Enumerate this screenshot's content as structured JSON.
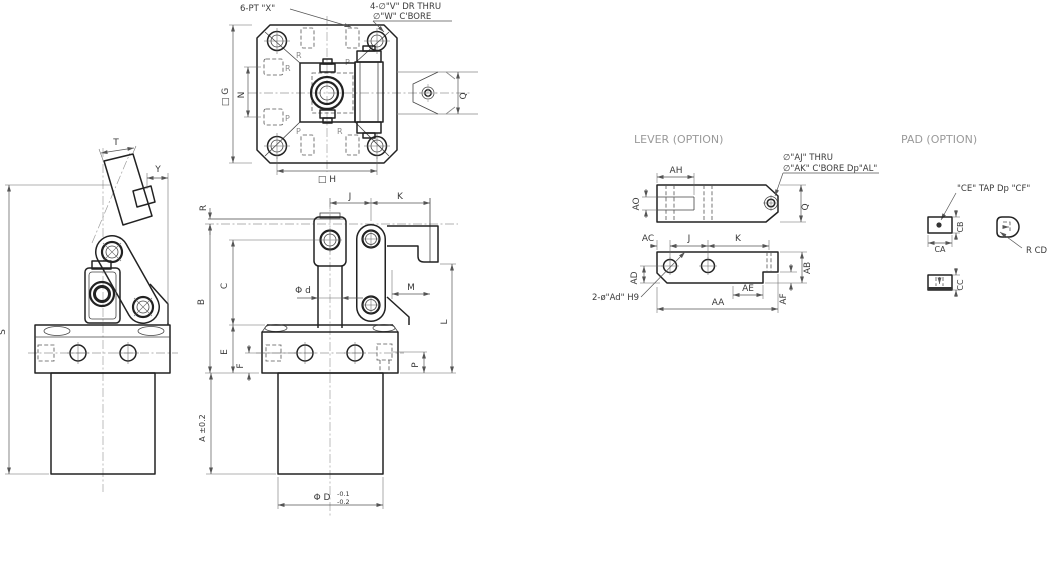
{
  "titles": {
    "lever": "LEVER (OPTION)",
    "pad": "PAD (OPTION)"
  },
  "top_view": {
    "callout_port": "6-PT \"X\"",
    "callout_hole1": "4-∅\"V\" DR THRU",
    "callout_hole2": "∅\"W\" C'BORE",
    "dim_g": "□ G",
    "dim_n": "N",
    "dim_h": "□ H",
    "dim_q": "Q",
    "port_r": "R",
    "port_p": "P"
  },
  "side_view": {
    "dim_t": "T",
    "dim_y": "Y",
    "dim_s": "S"
  },
  "front_view": {
    "dim_r": "R",
    "dim_j": "J",
    "dim_k": "K",
    "dim_b": "B",
    "dim_c": "C",
    "dim_d_small": "Φ d",
    "dim_m": "M",
    "dim_l": "L",
    "dim_e": "E",
    "dim_f": "F",
    "dim_p": "P",
    "dim_a": "A ±0.2",
    "dim_D": "Φ D",
    "tol_top": "-0.1",
    "tol_bot": "-0.2"
  },
  "lever": {
    "dim_ao": "AO",
    "dim_ah": "AH",
    "callout1": "∅\"AJ\" THRU",
    "callout2": "∅\"AK\" C'BORE Dp\"AL\"",
    "dim_q": "Q",
    "dim_ac": "AC",
    "dim_j": "J",
    "dim_k": "K",
    "dim_ad": "AD",
    "dim_ab": "AB",
    "dim_ae": "AE",
    "dim_af": "AF",
    "dim_aa": "AA",
    "callout_pins": "2-ø\"Ad\" H9"
  },
  "pad": {
    "callout_tap": "\"CE\" TAP Dp \"CF\"",
    "dim_cb": "CB",
    "dim_ca": "CA",
    "callout_r": "R CD",
    "dim_cc": "CC"
  }
}
